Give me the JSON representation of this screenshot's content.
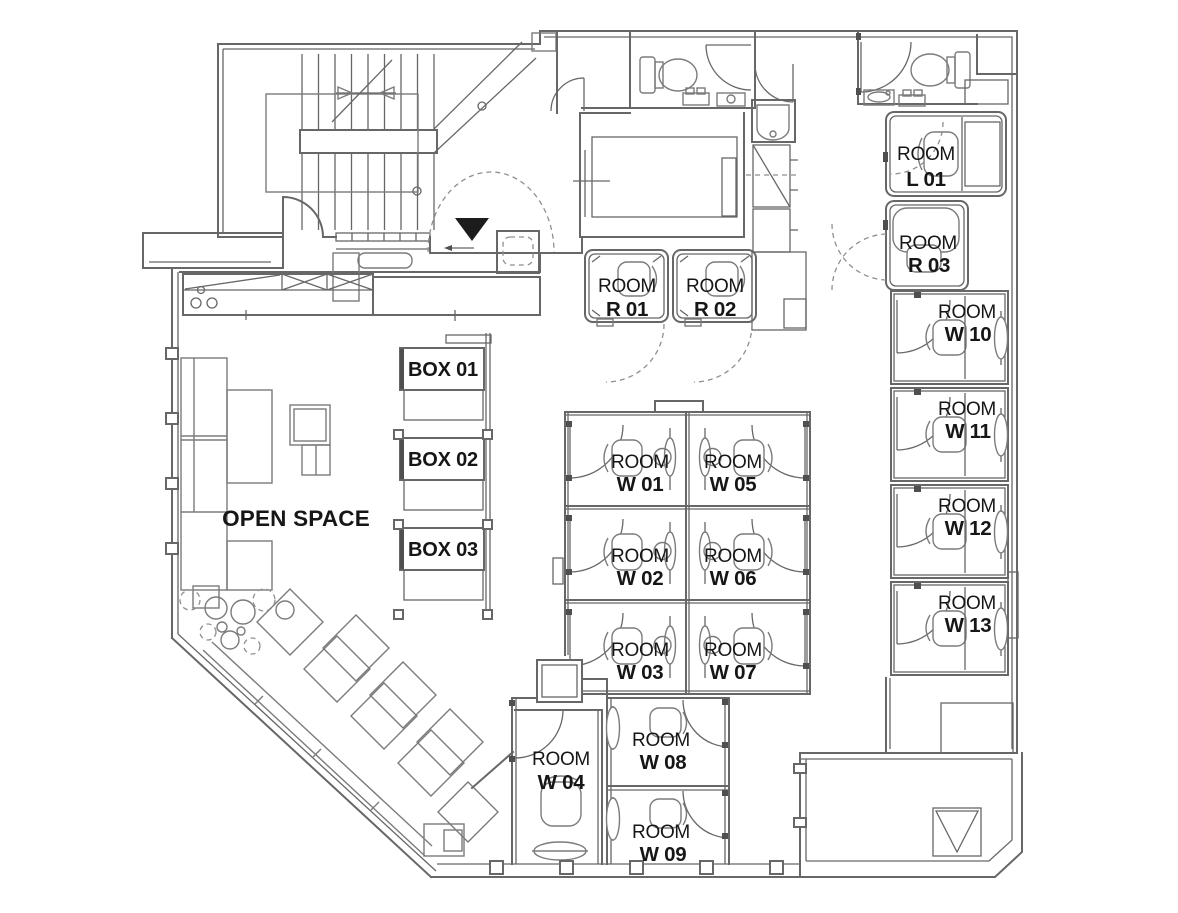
{
  "plan": {
    "open_space_label": "OPEN SPACE",
    "boxes": [
      "BOX 01",
      "BOX 02",
      "BOX 03"
    ],
    "rooms": {
      "r01": {
        "title": "ROOM",
        "number": "R 01"
      },
      "r02": {
        "title": "ROOM",
        "number": "R 02"
      },
      "l01": {
        "title": "ROOM",
        "number": "L 01"
      },
      "r03": {
        "title": "ROOM",
        "number": "R 03"
      },
      "w01": {
        "title": "ROOM",
        "number": "W 01"
      },
      "w02": {
        "title": "ROOM",
        "number": "W 02"
      },
      "w03": {
        "title": "ROOM",
        "number": "W 03"
      },
      "w04": {
        "title": "ROOM",
        "number": "W 04"
      },
      "w05": {
        "title": "ROOM",
        "number": "W 05"
      },
      "w06": {
        "title": "ROOM",
        "number": "W 06"
      },
      "w07": {
        "title": "ROOM",
        "number": "W 07"
      },
      "w08": {
        "title": "ROOM",
        "number": "W 08"
      },
      "w09": {
        "title": "ROOM",
        "number": "W 09"
      },
      "w10": {
        "title": "ROOM",
        "number": "W 10"
      },
      "w11": {
        "title": "ROOM",
        "number": "W 11"
      },
      "w12": {
        "title": "ROOM",
        "number": "W 12"
      },
      "w13": {
        "title": "ROOM",
        "number": "W 13"
      }
    },
    "colors": {
      "wall_line": "#676767",
      "furniture_line": "#7b7b7b",
      "dashed_line": "#8f8f8f",
      "label_text": "#161616",
      "entrance_marker": "#1c1c1c",
      "background": "#ffffff"
    }
  }
}
